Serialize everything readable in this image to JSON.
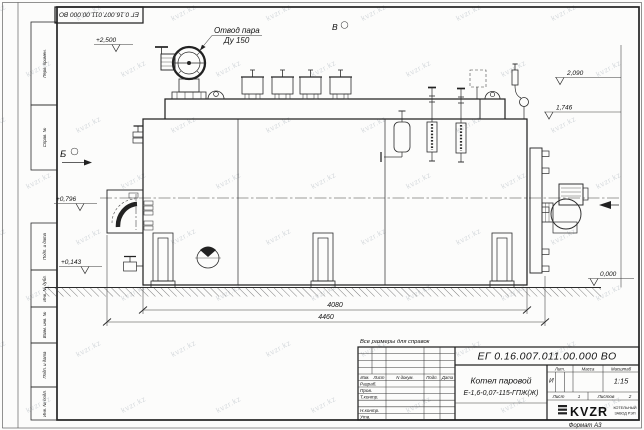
{
  "document": {
    "number": "ЕГ 0.16.007.011.00.000  ВО",
    "number_flipped": "ЕГ 0.16.007.011.00.000  ВО",
    "title_line1": "Котел паровой",
    "title_line2": "Е-1,6-0,07-115-ГПЖ(Ж)",
    "note": "Все размеры для справок",
    "format": "Формат А3"
  },
  "title_block": {
    "change_header": [
      "Изм.",
      "Лист",
      "N докум.",
      "Подп.",
      "Дата"
    ],
    "rows": [
      "Разраб.",
      "Пров.",
      "Т.контр.",
      "Н.контр.",
      "Утв."
    ],
    "lit_header": "Лит.",
    "mass_header": "Масса",
    "scale_header": "Масштаб",
    "lit_value": "И",
    "scale": "1:15",
    "sheet": {
      "label": "Лист",
      "value": "1",
      "of_label": "Листов",
      "of_value": "2"
    },
    "logo": "KVZR",
    "logo_sub1": "КОТЕЛЬНЫЙ",
    "logo_sub2": "ЗАВОД РЭП"
  },
  "margin_boxes": [
    "Перв. примен.",
    "Справ. №",
    "Подп. и дата",
    "Инв. № дубл.",
    "Взам. инв. №",
    "Подп. и дата",
    "Инв. № подл."
  ],
  "annotations": {
    "steam_outlet_1": "Отвод пара",
    "steam_outlet_2": "Ду 150",
    "view_b": "Б",
    "view_v": "В",
    "elev_2500": "+2,500",
    "elev_2090": "2,090",
    "elev_1746": "1,746",
    "elev_0796": "+0,796",
    "elev_0143": "+0,143",
    "elev_0000": "0,000",
    "dim_4080": "4080",
    "dim_4460": "4460"
  },
  "watermark": {
    "text": "kvzr.kz"
  }
}
